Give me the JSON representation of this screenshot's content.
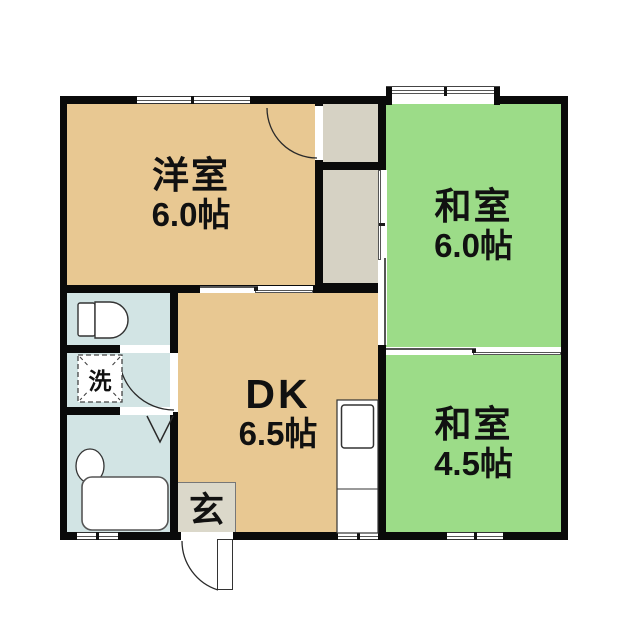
{
  "plan": {
    "type": "apartment-floor-plan",
    "rooms": [
      {
        "name": "洋室",
        "size": "6.0帖"
      },
      {
        "name": "和室",
        "size": "6.0帖"
      },
      {
        "name": "和室",
        "size": "4.5帖"
      },
      {
        "name": "DK",
        "size": "6.5帖"
      }
    ],
    "labels": {
      "entrance": "玄",
      "laundry": "洗"
    },
    "colors": {
      "western_room": "#e8c892",
      "japanese_room": "#9cdc88",
      "wet_area": "#d2e4e4",
      "closet": "#d6d2c4",
      "entrance": "#dbd8ca",
      "wall": "#0a0a0a",
      "fixture_stroke": "#333333"
    }
  }
}
